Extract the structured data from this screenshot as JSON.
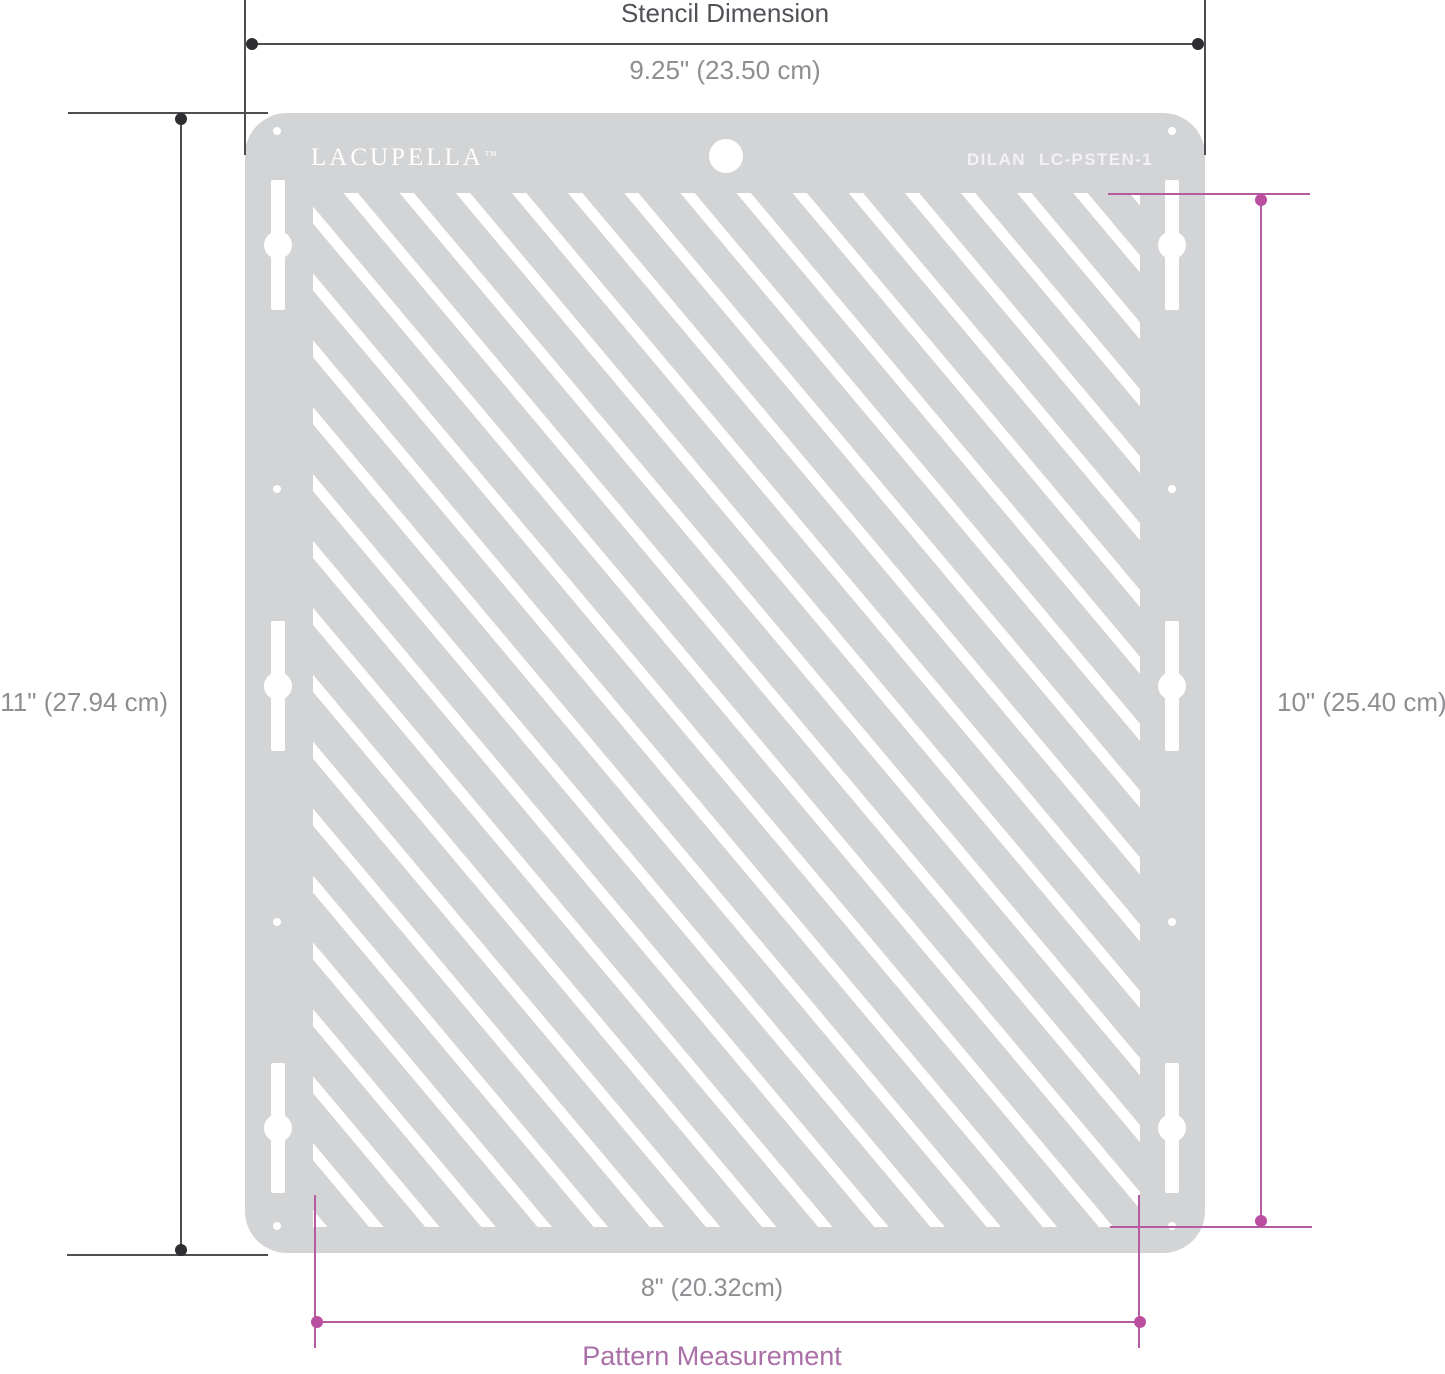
{
  "stencil": {
    "brand": "LACUPELLA",
    "brand_trademark": "TM",
    "model": {
      "name": "DILAN",
      "code": "LC-PSTEN-1"
    }
  },
  "annotations": {
    "top": {
      "title": "Stencil Dimension",
      "value": "9.25\" (23.50 cm)"
    },
    "left": {
      "value": "11\" (27.94 cm)"
    },
    "right": {
      "value": "10\" (25.40 cm)"
    },
    "bottom": {
      "value": "8\" (20.32cm)",
      "title": "Pattern Measurement"
    }
  },
  "colors": {
    "dark_line": "#4e4e52",
    "dark_dot": "#2e2e31",
    "gray_text": "#8e8e93",
    "dark_text": "#515257",
    "pink_line": "#b45c9f",
    "pink_dot": "#bb4f9f",
    "pink_text": "#aa70a7",
    "plate": "#d3d4d6",
    "slot": "#ffffff"
  }
}
